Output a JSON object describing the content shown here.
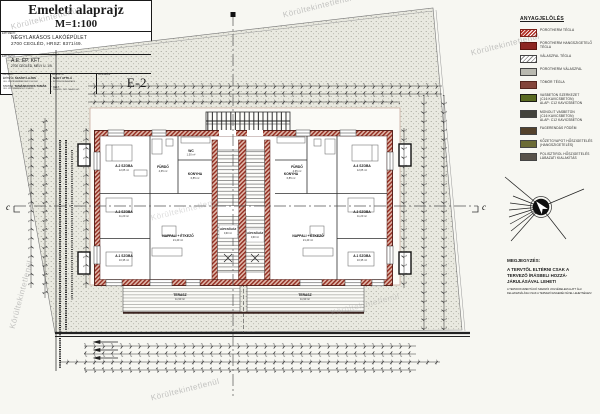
{
  "watermark": {
    "text": "Körültekintetlenül"
  },
  "legend": {
    "title": "ANYAGJELÖLÉS",
    "items": [
      {
        "swatch": "porotherm",
        "lines": [
          "POROTHERM TÉGLA"
        ]
      },
      {
        "swatch": "hang",
        "lines": [
          "POROTHERM HANGSZIGETELŐ TÉGLA"
        ]
      },
      {
        "swatch": "valaszfal",
        "lines": [
          "VÁLASZFAL TÉGLA"
        ]
      },
      {
        "swatch": "pvalaszfal",
        "lines": [
          "POROTHERM VÁLASZFAL"
        ]
      },
      {
        "swatch": "tomor",
        "lines": [
          "TÖMÖR TÉGLA"
        ]
      },
      {
        "swatch": "vasbeton",
        "lines": [
          "VASBETON SZERKEZET",
          "(C16 KAVICSBETON)",
          "ALAP: C12 KAVICSBETON"
        ]
      },
      {
        "swatch": "monolit",
        "lines": [
          "MONOLIT VASBETON",
          "(C16 KAVICSBETON)",
          "ALAP: C12 KAVICSBETON"
        ]
      },
      {
        "swatch": "fa",
        "lines": [
          "FAGERENDÁS FÖDÉM"
        ]
      },
      {
        "swatch": "kozet",
        "lines": [
          "KŐZETGYAPOT HŐSZIGETELÉS",
          "(HANGSZIGETELÉS)"
        ]
      },
      {
        "swatch": "poli",
        "lines": [
          "POLISZTIROL HŐSZIGETELÉS",
          "LÁBAZATI KIALAKÍTÁS"
        ]
      }
    ]
  },
  "note": {
    "title": "MEGJEGYZÉS:",
    "lines": [
      "A TERVTŐL ELTÉRNI CSAK A",
      "TERVEZŐ ÍRÁSBELI HOZZÁ-",
      "JÁRULÁSÁVAL LEHET!"
    ],
    "small": [
      "A TERVDOKUMENTÁCIÓ SZERZŐI JOGVÉDELEM ALATT ÁLL!",
      "FELHASZNÁLÁSA CSAK A TERVEZŐ ENGEDÉLYÉVEL LEHETSÉGES!"
    ]
  },
  "section": {
    "label": "c"
  },
  "plan": {
    "rooms": [
      {
        "name": "A.2 SZOBA",
        "area": "12,65 m²"
      },
      {
        "name": "FÜRDŐ",
        "area": "4,65 m²"
      },
      {
        "name": "WC",
        "area": "1,50 m²"
      },
      {
        "name": "KONYHA",
        "area": "6,85 m²"
      },
      {
        "name": "A.3 SZOBA",
        "area": "11,20 m²"
      },
      {
        "name": "A.1 SZOBA",
        "area": "10,35 m²"
      },
      {
        "name": "NAPPALI + ÉTKEZŐ",
        "area": "21,40 m²"
      },
      {
        "name": "LÉPCSŐHÁZ",
        "area": "9,90 m²"
      },
      {
        "name": "LÉPCSŐHÁZ",
        "area": "9,90 m²"
      },
      {
        "name": "FÜRDŐ",
        "area": "4,65 m²"
      },
      {
        "name": "KONYHA",
        "area": "6,85 m²"
      },
      {
        "name": "A.4 SZOBA",
        "area": "12,65 m²"
      },
      {
        "name": "A.3 SZOBA",
        "area": "11,20 m²"
      },
      {
        "name": "A.1 SZOBA",
        "area": "10,35 m²"
      },
      {
        "name": "NAPPALI + ÉTKEZŐ",
        "area": "21,40 m²"
      },
      {
        "name": "TERASZ",
        "area": "11,90 m²"
      },
      {
        "name": "TERASZ",
        "area": "11,90 m²"
      }
    ]
  },
  "titleblock": {
    "drawing_title": "Emeleti alaprajz",
    "scale": "M=1:100",
    "project_caption": "ÉPÍTMÉNY:",
    "project_line1": "NÉGYLAKÁSOS LAKÓÉPÜLET",
    "project_line2": "2700 CEGLÉD, HRSZ: 8371/49.",
    "client_caption": "ÉPÍTTETŐ:",
    "client_line1": "A.E. ÉP. KFT.",
    "client_line2": "2700 CEGLÉD, MÉLY U. 1/9.",
    "sig": {
      "col1_caption": "TERVEZŐ:",
      "row1_role": "ÉPÍTÉSZ:",
      "row1_name": "SZANYI LAJOS",
      "row1_cred": "OKL. ÉPÍTÉSZMÉRNÖK É/1 13-1102",
      "row2_role": "STATIKA:",
      "row2_name": "TAMÁSKOVICS TAMÁS",
      "row2_cred": "OKL. ÉPÍTŐMÉRNÖK T-13-8811",
      "col2_caption": "RAJZOLTA:",
      "col2_name": "NAGY ATTILA",
      "col2_cred": "ÉPÍTÉSZ MUNKATÁRS",
      "date_caption": "KELT:",
      "date": "CEGLÉD, 2021. MÁJUS HÓ",
      "sheet_caption": "RAJZSZÁM:",
      "sheet_no": "E-2"
    }
  }
}
